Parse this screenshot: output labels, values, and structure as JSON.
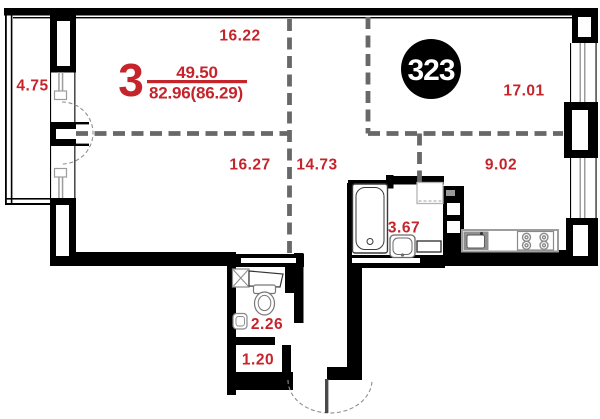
{
  "document": {
    "type": "apartment-floor-plan"
  },
  "apartment": {
    "number": "323",
    "rooms_count": "3",
    "area_living": "49.50",
    "area_total": "82.96(86.29)"
  },
  "rooms": {
    "room_top_left": "16.22",
    "room_bottom_left": "16.27",
    "hallway": "14.73",
    "room_top_right": "17.01",
    "kitchen": "9.02",
    "bathroom": "3.67",
    "wc": "2.26",
    "storage": "1.20",
    "balcony": "4.75"
  },
  "colors": {
    "label_red": "#c5242b",
    "wall_black": "#000000",
    "zone_dash": "#686868",
    "fixture_gray": "#999999",
    "badge_text": "#ffffff"
  }
}
